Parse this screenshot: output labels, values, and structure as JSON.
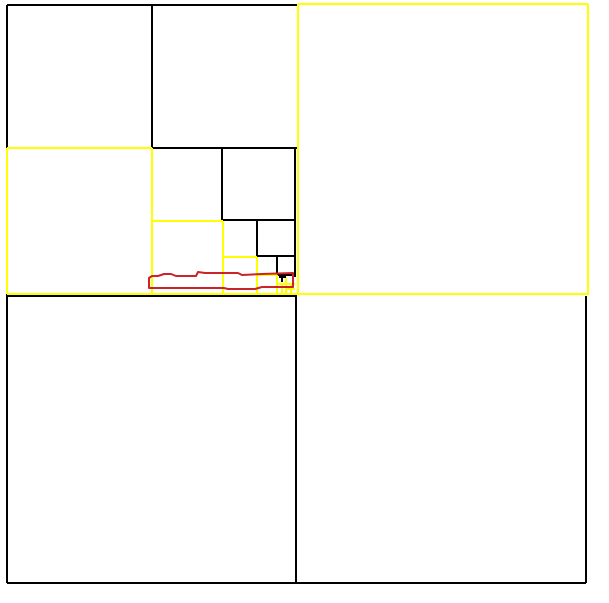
{
  "canvas": {
    "width": 609,
    "height": 603,
    "background": "#ffffff"
  },
  "palette": {
    "black": "#000000",
    "yellow": "#ffff00",
    "red": "#cc2229"
  },
  "figure": {
    "name": "recursive-square-subdivision",
    "stroke_width": 2,
    "segments": [
      {
        "name": "outer-top-edge",
        "color": "black",
        "points": [
          7,
          5,
          297,
          5
        ]
      },
      {
        "name": "outer-left-edge-upper",
        "color": "black",
        "points": [
          7,
          5,
          7,
          148
        ]
      },
      {
        "name": "outer-left-edge-lower",
        "color": "black",
        "points": [
          7,
          294,
          7,
          583
        ]
      },
      {
        "name": "outer-bottom-edge",
        "color": "black",
        "points": [
          7,
          583,
          586,
          583
        ]
      },
      {
        "name": "outer-right-edge-lower",
        "color": "black",
        "points": [
          586,
          296,
          586,
          583
        ]
      },
      {
        "name": "bottom-quadrant-divider",
        "color": "black",
        "points": [
          296,
          296,
          296,
          583
        ]
      },
      {
        "name": "bottom-left-square-top-edge",
        "color": "black",
        "points": [
          7,
          296,
          297,
          296
        ]
      },
      {
        "name": "level2-vertical-divider",
        "color": "black",
        "points": [
          152,
          5,
          152,
          148
        ]
      },
      {
        "name": "level2-horizontal-divider",
        "color": "black",
        "points": [
          152,
          148,
          297,
          148
        ]
      },
      {
        "name": "level3-vertical-divider",
        "color": "black",
        "points": [
          222,
          148,
          222,
          220
        ]
      },
      {
        "name": "level3-tr-square-bottom-edge",
        "color": "black",
        "points": [
          222,
          220,
          295,
          220
        ]
      },
      {
        "name": "level3-5-right-edge",
        "color": "black",
        "points": [
          295,
          148,
          295,
          277
        ]
      },
      {
        "name": "level4-vertical-divider",
        "color": "black",
        "points": [
          257,
          221,
          257,
          257
        ]
      },
      {
        "name": "level4-tr-square-bottom-edge",
        "color": "black",
        "points": [
          257,
          256,
          295,
          256
        ]
      },
      {
        "name": "level5-vertical-divider",
        "color": "black",
        "points": [
          277,
          257,
          277,
          275
        ]
      },
      {
        "name": "level5-tr-square-bottom-edge",
        "color": "black",
        "points": [
          277,
          275,
          295,
          275
        ]
      },
      {
        "name": "yellow-square-top-edge",
        "color": "yellow",
        "points": [
          298,
          4,
          588,
          4
        ]
      },
      {
        "name": "yellow-square-right-edge",
        "color": "yellow",
        "points": [
          588,
          4,
          588,
          295
        ]
      },
      {
        "name": "yellow-square-left-edge",
        "color": "yellow",
        "points": [
          298,
          4,
          298,
          294
        ]
      },
      {
        "name": "full-width-yellow-line",
        "color": "yellow",
        "points": [
          7,
          294,
          588,
          294
        ]
      },
      {
        "name": "left-yellow-square-left-edge",
        "color": "yellow",
        "points": [
          7,
          148,
          7,
          294
        ]
      },
      {
        "name": "left-yellow-square-top-edge",
        "color": "yellow",
        "points": [
          7,
          148,
          152,
          148
        ]
      },
      {
        "name": "left-yellow-square-right-edge",
        "color": "yellow",
        "points": [
          152,
          148,
          152,
          294
        ]
      },
      {
        "name": "level3-yellow-square-top-edge",
        "color": "yellow",
        "points": [
          152,
          221,
          223,
          221
        ]
      },
      {
        "name": "level3-yellow-square-right-edge",
        "color": "yellow",
        "points": [
          223,
          221,
          223,
          294
        ]
      },
      {
        "name": "level4-yellow-square-top-edge",
        "color": "yellow",
        "points": [
          223,
          257,
          257,
          257
        ]
      },
      {
        "name": "level4-yellow-square-right-edge",
        "color": "yellow",
        "points": [
          257,
          257,
          257,
          294
        ]
      },
      {
        "name": "level5-yellow-square-top-edge",
        "color": "yellow",
        "points": [
          257,
          275,
          277,
          275
        ]
      },
      {
        "name": "level5-yellow-square-right-edge",
        "color": "yellow",
        "points": [
          277,
          275,
          277,
          294
        ]
      },
      {
        "name": "level6-yellow-horizontal",
        "color": "yellow",
        "points": [
          277,
          284,
          295,
          284
        ]
      },
      {
        "name": "level6-yellow-vertical-a",
        "color": "yellow",
        "points": [
          282,
          284,
          282,
          294
        ]
      },
      {
        "name": "level6-yellow-vertical-b",
        "color": "yellow",
        "points": [
          286,
          277,
          286,
          294
        ]
      },
      {
        "name": "level7-yellow-horizontal",
        "color": "yellow",
        "points": [
          286,
          289,
          295,
          289
        ]
      },
      {
        "name": "level7-yellow-vertical",
        "color": "yellow",
        "points": [
          291,
          284,
          291,
          294
        ]
      },
      {
        "name": "t-mark-bar",
        "color": "black",
        "points": [
          279,
          277,
          286,
          277
        ]
      },
      {
        "name": "t-mark-stem",
        "color": "black",
        "points": [
          282,
          277,
          282,
          282
        ]
      }
    ],
    "freehand_strokes": [
      {
        "name": "red-freehand-rectangle",
        "color": "red",
        "width": 2,
        "closed": true,
        "points": [
          [
            149,
            278
          ],
          [
            152,
            276
          ],
          [
            158,
            276
          ],
          [
            164,
            274
          ],
          [
            171,
            274
          ],
          [
            176,
            276
          ],
          [
            196,
            276
          ],
          [
            198,
            272
          ],
          [
            205,
            273
          ],
          [
            238,
            273
          ],
          [
            242,
            275
          ],
          [
            262,
            274
          ],
          [
            293,
            273
          ],
          [
            293,
            287
          ],
          [
            262,
            287
          ],
          [
            255,
            289
          ],
          [
            228,
            289
          ],
          [
            224,
            288
          ],
          [
            160,
            288
          ],
          [
            149,
            288
          ]
        ]
      }
    ]
  }
}
